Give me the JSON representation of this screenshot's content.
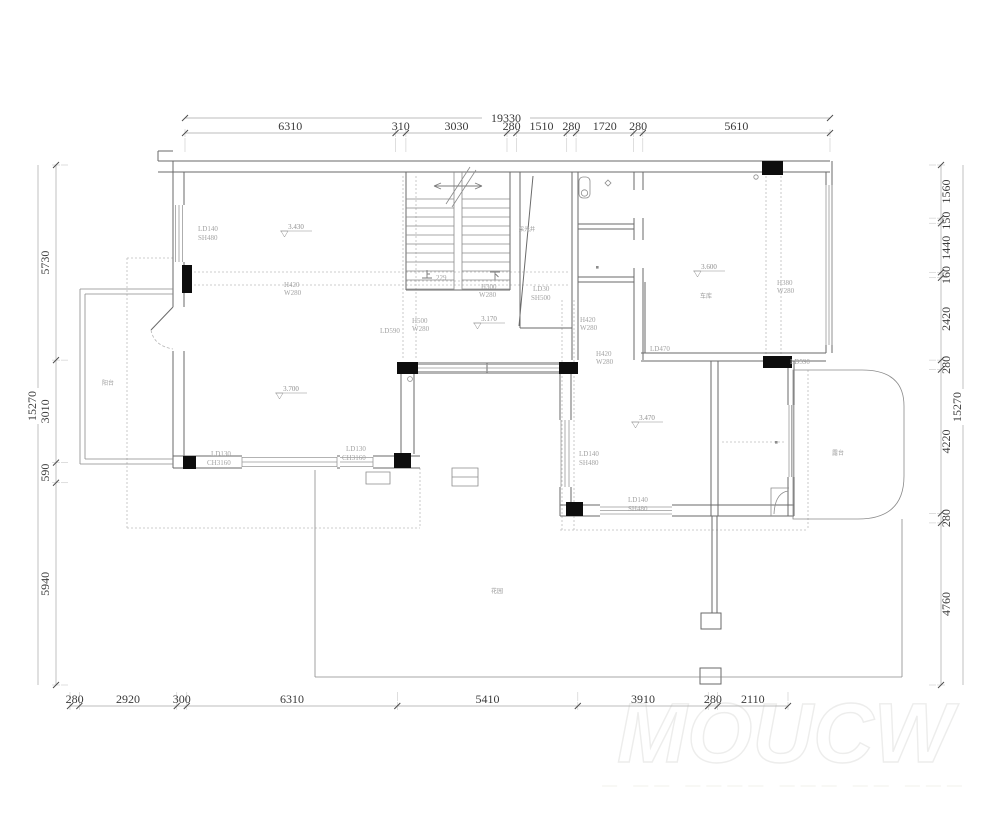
{
  "drawing": {
    "type": "architectural-floor-plan",
    "watermark": {
      "main": "MOUCW",
      "sub": "— —— ———— ——— —— ———"
    }
  },
  "dimensions": {
    "top": {
      "overall": "19330",
      "segments": [
        "6310",
        "310",
        "3030",
        "280",
        "1510",
        "280",
        "1720",
        "280",
        "5610"
      ]
    },
    "bottom": {
      "segments": [
        "280",
        "2920",
        "300",
        "6310",
        "5410",
        "3910",
        "280",
        "2110"
      ]
    },
    "left": {
      "overall": "15270",
      "segments": [
        "5730",
        "3010",
        "590",
        "5940"
      ]
    },
    "right": {
      "overall": "15270",
      "segments": [
        "1560",
        "150",
        "1440",
        "160",
        "2420",
        "280",
        "4220",
        "280",
        "4760"
      ]
    }
  },
  "elevations": [
    {
      "value": "3.430",
      "x": 296,
      "y": 229
    },
    {
      "value": "3.700",
      "x": 291,
      "y": 391
    },
    {
      "value": "3.170",
      "x": 489,
      "y": 321
    },
    {
      "value": "3.600",
      "x": 709,
      "y": 269
    },
    {
      "value": "3.470",
      "x": 647,
      "y": 420
    }
  ],
  "room_labels": [
    {
      "text": "采光井",
      "x": 527,
      "y": 231,
      "size": 5.5
    },
    {
      "text": "阳台",
      "x": 108,
      "y": 385,
      "size": 6
    },
    {
      "text": "车库",
      "x": 706,
      "y": 298,
      "size": 6
    },
    {
      "text": "露台",
      "x": 838,
      "y": 455,
      "size": 6
    },
    {
      "text": "花园",
      "x": 497,
      "y": 593,
      "size": 6
    }
  ],
  "stairs": {
    "up": "上",
    "count": "229",
    "down": "下"
  },
  "annotations": [
    {
      "text": "LD140",
      "x": 198,
      "y": 231
    },
    {
      "text": "SH480",
      "x": 198,
      "y": 240
    },
    {
      "text": "H420",
      "x": 284,
      "y": 287
    },
    {
      "text": "W280",
      "x": 284,
      "y": 295
    },
    {
      "text": "LD590",
      "x": 380,
      "y": 333
    },
    {
      "text": "H500",
      "x": 412,
      "y": 323
    },
    {
      "text": "W280",
      "x": 412,
      "y": 331
    },
    {
      "text": "H300",
      "x": 481,
      "y": 289
    },
    {
      "text": "W280",
      "x": 479,
      "y": 297
    },
    {
      "text": "LD30",
      "x": 533,
      "y": 291
    },
    {
      "text": "SH500",
      "x": 531,
      "y": 300
    },
    {
      "text": "H420",
      "x": 580,
      "y": 322
    },
    {
      "text": "W280",
      "x": 580,
      "y": 330
    },
    {
      "text": "H420",
      "x": 596,
      "y": 356
    },
    {
      "text": "W280",
      "x": 596,
      "y": 364
    },
    {
      "text": "LD470",
      "x": 650,
      "y": 351
    },
    {
      "text": "H380",
      "x": 777,
      "y": 285
    },
    {
      "text": "W280",
      "x": 777,
      "y": 293
    },
    {
      "text": "LD590",
      "x": 790,
      "y": 364
    },
    {
      "text": "LD130",
      "x": 211,
      "y": 456
    },
    {
      "text": "CH3160",
      "x": 207,
      "y": 465
    },
    {
      "text": "LD130",
      "x": 346,
      "y": 451
    },
    {
      "text": "CH3160",
      "x": 342,
      "y": 460
    },
    {
      "text": "LD140",
      "x": 579,
      "y": 456
    },
    {
      "text": "SH480",
      "x": 579,
      "y": 465
    },
    {
      "text": "LD140",
      "x": 628,
      "y": 502
    },
    {
      "text": "SH480",
      "x": 628,
      "y": 511
    }
  ],
  "colors": {
    "wall": "#6a6a6a",
    "column": "#0d0d0d",
    "dim_text": "#3a3a3a",
    "annotation": "#a3a3a3"
  }
}
